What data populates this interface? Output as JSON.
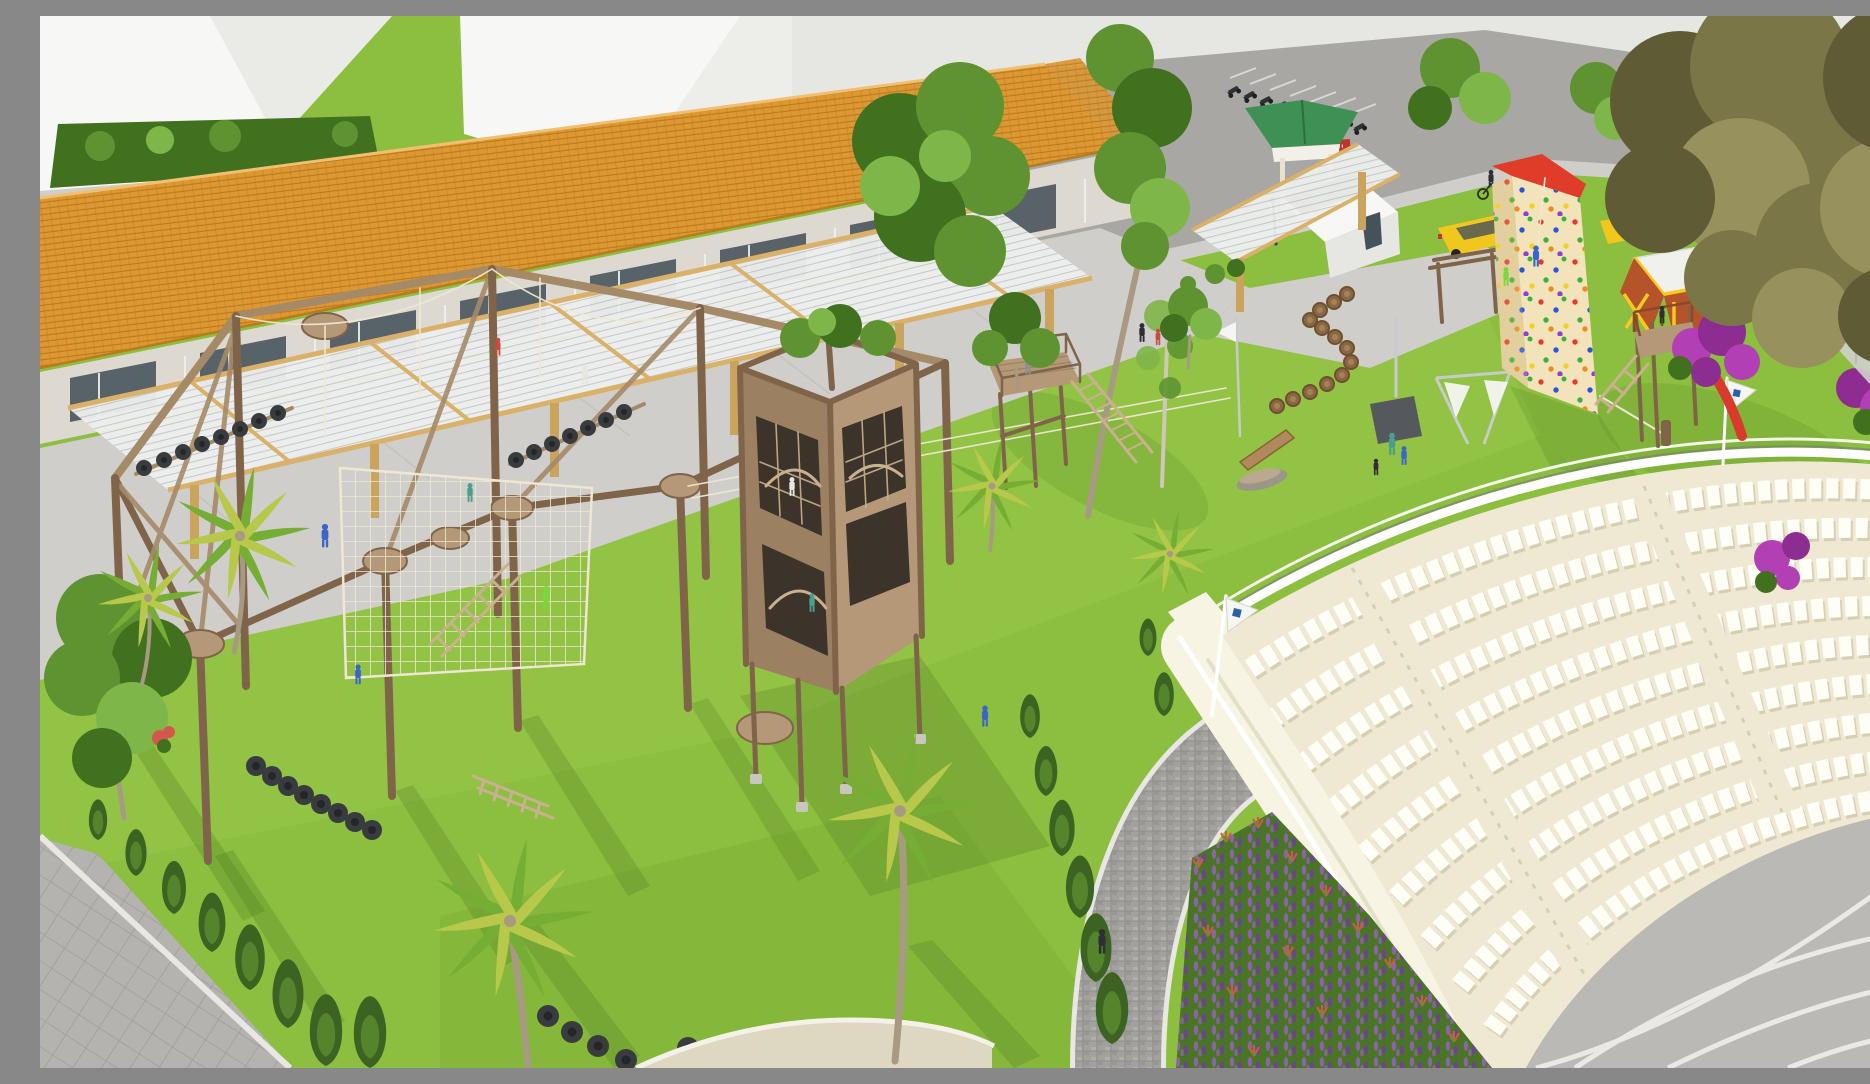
{
  "scene": {
    "description": "Aerial 3D architectural rendering of a family adventure park: a timber high-ropes course with climbing nets and tire obstacles, a wooden spiral-stair tower, a three-sided climbing wall with multicolored holds, a yellow-and-red playhouse with slide tower, stepping-log trail, palm trees and lawns, a long tile-roofed building with slatted pergola, street parking with motorcycles and yellow cars, and a large semicircular white amphitheater with stage at lower right.",
    "people_visible": 19,
    "amphitheater": {
      "seat_rows": 9,
      "seat_color": "#fefdf6",
      "flags": 2
    },
    "signage": {
      "red_banner_text_legible": false
    },
    "vehicles": {
      "yellow_cars": 2,
      "motorcycles": 9,
      "bicycles": 1
    },
    "palette": {
      "grass": "#8cbe3f",
      "grassLight": "#9ecf4e",
      "grassDark": "#6e9e2a",
      "shadowGreen": "#3f6b1f",
      "roadGrey": "#a8a7a3",
      "pavement": "#cfcecb",
      "plazaGrey": "#b4b3af",
      "curbWhite": "#e8e7e3",
      "buildingWhite": "#f7f7f5",
      "buildingShade": "#e6e6e2",
      "wallStone": "#ddd9d0",
      "glassDark": "#46525a",
      "glassFrame": "#f0efeb",
      "roofTile": "#dd9733",
      "roofTileDark": "#b87b1e",
      "slatLight": "#edefee",
      "slatDark": "#c7c9c8",
      "pergolaBeam": "#d9b168",
      "woodPost": "#caa45c",
      "timber": "#a58a68",
      "timberDark": "#7f644a",
      "timberLight": "#c9b190",
      "deckWood": "#b59877",
      "rope": "#efe7d2",
      "tire": "#393c3f",
      "amphCream": "#efe9d3",
      "amphWall": "#f8f4e4",
      "seatWhite": "#fefdf6",
      "seatShadow": "#d6d0b2",
      "stageGrey": "#bab9b5",
      "stageLine": "#f0efec",
      "cobble": "#a2a19e",
      "cobbleDark": "#8f8e8b",
      "hedgeGreen": "#3c6322",
      "treeGreen": "#5f9331",
      "treeDark": "#41701f",
      "treeLight": "#7fb649",
      "oliveGreen": "#7a7647",
      "oliveDark": "#5f5c35",
      "oliveLight": "#96915d",
      "palmGreen": "#76ad35",
      "palmYellow": "#b8c84a",
      "trunkGrey": "#a89a82",
      "lavender": "#9361b8",
      "lavenderDark": "#6d4390",
      "flowerRed": "#d4574e",
      "bedGreen": "#4a7527",
      "bougainvillea": "#b33fb5",
      "bougainvilleaDark": "#8e2d91",
      "climbWall": "#f3e3ba",
      "climbWallShade": "#e3cf9e",
      "climbRed": "#e03c2a",
      "holdRed": "#e23a2e",
      "holdBlue": "#2b56d6",
      "holdYellow": "#f2d023",
      "holdGreen": "#3fae3a",
      "holdPurple": "#8f3fd6",
      "holdOrange": "#f08c1e",
      "playYellow": "#f7c81e",
      "playRed": "#b5532b",
      "playWhite": "#f0f1ed",
      "slideRed": "#d93a2c",
      "gazeboGreen": "#3f9055",
      "carYellow": "#f2c71d",
      "metalGrey": "#c9cacc",
      "darkMetal": "#55585c",
      "flagWhite": "#f5f5f3",
      "flagBlue": "#2f5fa8",
      "bannerRed": "#c2332b",
      "figBlue": "#3a66c9",
      "figGreen": "#7ed63f",
      "figDark": "#2e2e34",
      "figTeal": "#4a9e8f",
      "figRed": "#c84b3f",
      "figGrey": "#8e8e93",
      "figWhite": "#e8e6e0",
      "courtGreen": "#3e7d46",
      "concreteFoot": "#c9c6bf",
      "soil": "#7a5d3e"
    }
  }
}
